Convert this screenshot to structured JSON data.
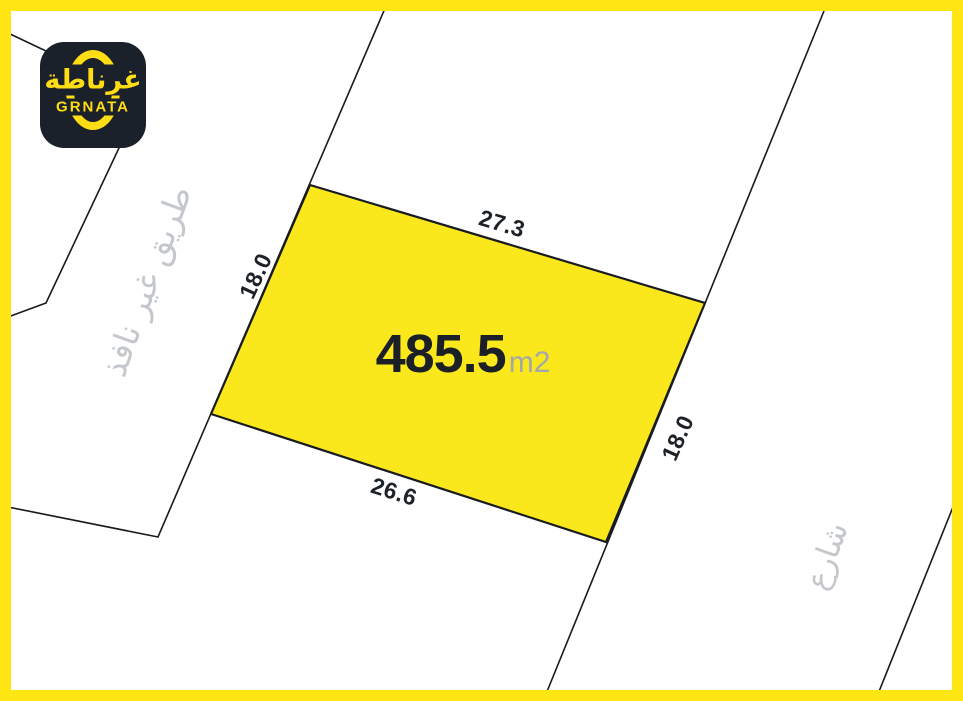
{
  "page": {
    "title": "Grnata land plot map"
  },
  "colors": {
    "frame_yellow": "#FFE512",
    "plot_fill": "#FAE71C",
    "boundary_line": "#1A1A1A",
    "dimension_text": "#1D2227",
    "street_text": "#C4C8CC",
    "area_value_text": "#1B2026",
    "area_unit_text": "#A2A7AC",
    "logo_background": "#1B212B",
    "logo_accent": "#FFDD15"
  },
  "logo": {
    "brand_arabic": "غرناطة",
    "brand_latin": "GRNATA"
  },
  "plot": {
    "area_value": "485.5",
    "area_unit": "m2",
    "dim_top": "27.3",
    "dim_bottom": "26.6",
    "dim_left": "18.0",
    "dim_right": "18.0"
  },
  "streets": {
    "road_left_label": "طريق غير نافذ",
    "street_right_label": "شارع"
  }
}
